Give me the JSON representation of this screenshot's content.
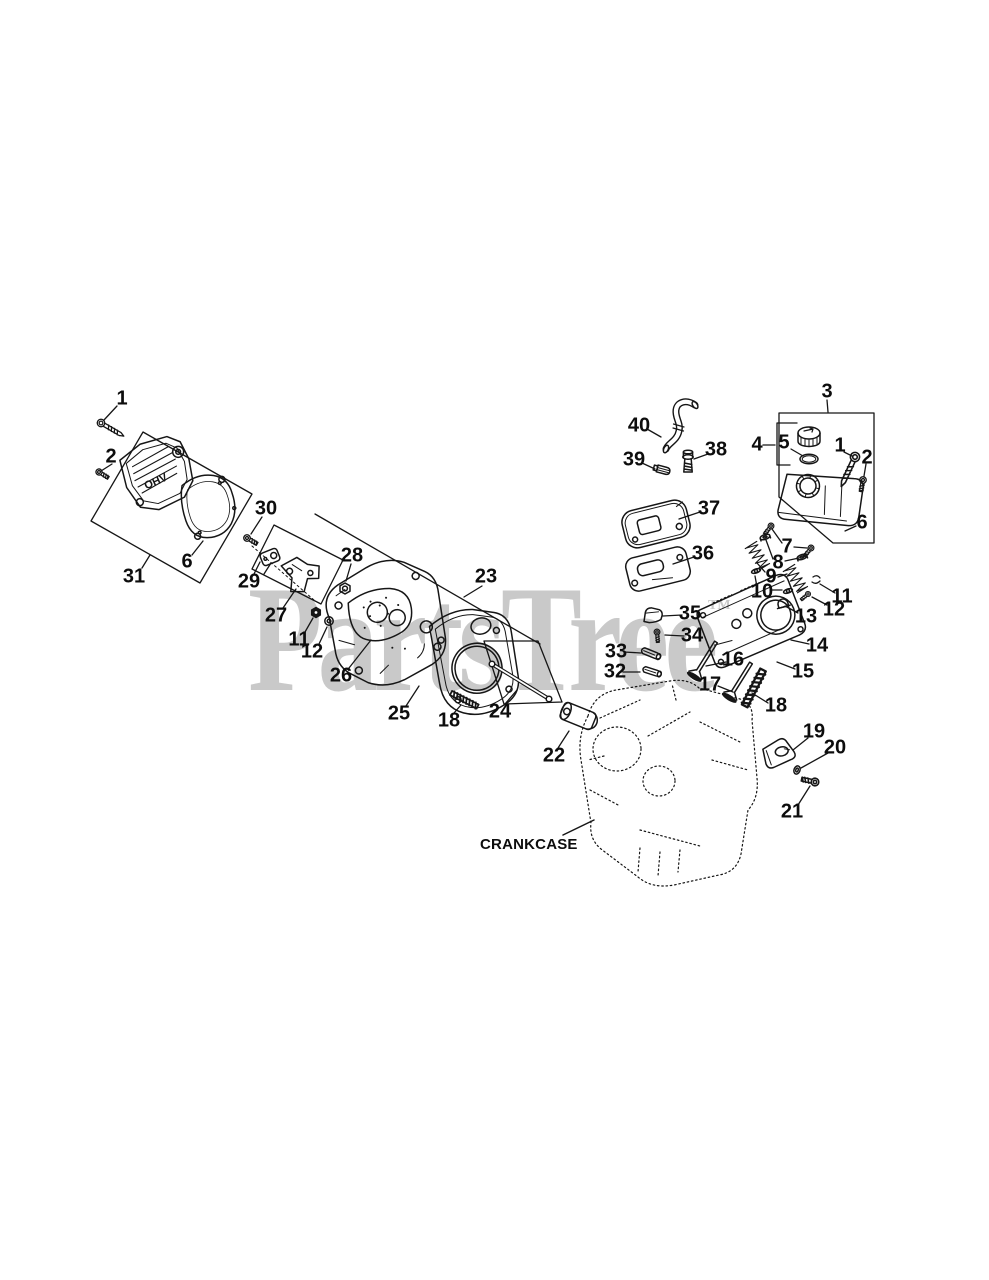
{
  "image": {
    "background": "#ffffff",
    "line_color": "#161616"
  },
  "watermark": {
    "text": "PartsTree",
    "tm": "TM",
    "color": "#c9c9c9"
  },
  "diagram": {
    "crankcase_label": "CRANKCASE",
    "cover_text": "OHV",
    "callouts": [
      {
        "n": "1",
        "x": 122,
        "y": 399,
        "L": [
          [
            117,
            406,
            104,
            420
          ]
        ]
      },
      {
        "n": "2",
        "x": 111,
        "y": 457,
        "L": [
          [
            112,
            464,
            101,
            471
          ]
        ]
      },
      {
        "n": "31",
        "x": 134,
        "y": 577,
        "L": [
          [
            142,
            568,
            150,
            555
          ]
        ]
      },
      {
        "n": "6",
        "x": 187,
        "y": 562,
        "L": [
          [
            192,
            555,
            203,
            541
          ]
        ]
      },
      {
        "n": "30",
        "x": 266,
        "y": 509,
        "L": [
          [
            262,
            517,
            251,
            534
          ]
        ]
      },
      {
        "n": "29",
        "x": 249,
        "y": 582,
        "L": [
          [
            254,
            574,
            260,
            562
          ],
          [
            264,
            574,
            271,
            563
          ]
        ]
      },
      {
        "n": "27",
        "x": 276,
        "y": 616,
        "L": [
          [
            283,
            608,
            296,
            589
          ]
        ]
      },
      {
        "n": "28",
        "x": 352,
        "y": 556,
        "L": [
          [
            351,
            564,
            346,
            581
          ]
        ]
      },
      {
        "n": "11",
        "x": 299,
        "y": 640,
        "L": [
          [
            305,
            632,
            313,
            618
          ]
        ]
      },
      {
        "n": "12",
        "x": 312,
        "y": 652,
        "L": [
          [
            319,
            644,
            327,
            627
          ]
        ]
      },
      {
        "n": "26",
        "x": 341,
        "y": 676,
        "L": [
          [
            349,
            668,
            371,
            640
          ]
        ]
      },
      {
        "n": "23",
        "x": 486,
        "y": 577,
        "L": [
          [
            482,
            586,
            464,
            597
          ]
        ]
      },
      {
        "n": "25",
        "x": 399,
        "y": 714,
        "L": [
          [
            406,
            706,
            419,
            686
          ]
        ]
      },
      {
        "n": "18",
        "x": 449,
        "y": 721,
        "L": [
          [
            454,
            713,
            461,
            705
          ]
        ]
      },
      {
        "n": "24",
        "x": 500,
        "y": 712,
        "L": [
          [
            505,
            704,
            517,
            690
          ]
        ]
      },
      {
        "n": "22",
        "x": 554,
        "y": 756,
        "L": [
          [
            558,
            748,
            569,
            731
          ]
        ]
      },
      {
        "n": "40",
        "x": 639,
        "y": 426,
        "L": [
          [
            647,
            429,
            661,
            437
          ]
        ]
      },
      {
        "n": "39",
        "x": 634,
        "y": 460,
        "L": [
          [
            642,
            463,
            655,
            469
          ]
        ]
      },
      {
        "n": "38",
        "x": 716,
        "y": 450,
        "L": [
          [
            708,
            454,
            694,
            459
          ]
        ]
      },
      {
        "n": "3",
        "x": 827,
        "y": 392,
        "L": [
          [
            827,
            400,
            828,
            412
          ]
        ]
      },
      {
        "n": "4",
        "x": 757,
        "y": 445,
        "L": [
          [
            763,
            445,
            775,
            445
          ]
        ]
      },
      {
        "n": "5",
        "x": 784,
        "y": 443,
        "L": [
          [
            791,
            449,
            803,
            456
          ]
        ]
      },
      {
        "n": "1",
        "x": 840,
        "y": 446,
        "L": [
          [
            844,
            452,
            852,
            456
          ]
        ]
      },
      {
        "n": "2",
        "x": 867,
        "y": 458,
        "L": [
          [
            866,
            464,
            864,
            476
          ]
        ]
      },
      {
        "n": "6",
        "x": 862,
        "y": 523,
        "L": [
          [
            856,
            526,
            845,
            531
          ]
        ]
      },
      {
        "n": "37",
        "x": 709,
        "y": 509,
        "L": [
          [
            700,
            512,
            679,
            519
          ]
        ]
      },
      {
        "n": "36",
        "x": 703,
        "y": 554,
        "L": [
          [
            694,
            557,
            673,
            564
          ]
        ]
      },
      {
        "n": "7",
        "x": 787,
        "y": 547,
        "L": [
          [
            782,
            543,
            772,
            529
          ],
          [
            794,
            547,
            807,
            548
          ]
        ]
      },
      {
        "n": "8",
        "x": 778,
        "y": 563,
        "L": [
          [
            773,
            559,
            766,
            540
          ],
          [
            785,
            561,
            799,
            558
          ]
        ]
      },
      {
        "n": "9",
        "x": 771,
        "y": 577,
        "L": [
          [
            765,
            572,
            757,
            563
          ],
          [
            778,
            577,
            787,
            574
          ]
        ]
      },
      {
        "n": "10",
        "x": 762,
        "y": 592,
        "L": [
          [
            770,
            590,
            782,
            590
          ],
          [
            757,
            587,
            755,
            576
          ]
        ]
      },
      {
        "n": "13",
        "x": 806,
        "y": 617,
        "L": [
          [
            798,
            613,
            785,
            606
          ]
        ]
      },
      {
        "n": "11",
        "x": 842,
        "y": 597,
        "L": [
          [
            835,
            593,
            820,
            584
          ]
        ]
      },
      {
        "n": "12",
        "x": 834,
        "y": 610,
        "L": [
          [
            827,
            605,
            812,
            597
          ]
        ]
      },
      {
        "n": "14",
        "x": 817,
        "y": 646,
        "L": [
          [
            809,
            644,
            791,
            640
          ]
        ]
      },
      {
        "n": "15",
        "x": 803,
        "y": 672,
        "L": [
          [
            795,
            669,
            777,
            662
          ]
        ]
      },
      {
        "n": "16",
        "x": 733,
        "y": 660,
        "L": [
          [
            726,
            662,
            706,
            666
          ]
        ]
      },
      {
        "n": "17",
        "x": 710,
        "y": 685,
        "L": [
          [
            718,
            686,
            733,
            692
          ]
        ]
      },
      {
        "n": "18",
        "x": 776,
        "y": 706,
        "L": [
          [
            768,
            703,
            752,
            693
          ]
        ]
      },
      {
        "n": "19",
        "x": 814,
        "y": 732,
        "L": [
          [
            808,
            738,
            793,
            750
          ]
        ]
      },
      {
        "n": "20",
        "x": 835,
        "y": 748,
        "L": [
          [
            828,
            753,
            801,
            768
          ]
        ]
      },
      {
        "n": "21",
        "x": 792,
        "y": 812,
        "L": [
          [
            798,
            805,
            810,
            786
          ]
        ]
      },
      {
        "n": "32",
        "x": 615,
        "y": 672,
        "L": [
          [
            623,
            672,
            640,
            672
          ]
        ]
      },
      {
        "n": "33",
        "x": 616,
        "y": 652,
        "L": [
          [
            624,
            652,
            641,
            653
          ]
        ]
      },
      {
        "n": "34",
        "x": 692,
        "y": 636,
        "L": [
          [
            684,
            636,
            665,
            635
          ]
        ]
      },
      {
        "n": "35",
        "x": 690,
        "y": 614,
        "L": [
          [
            682,
            615,
            663,
            616
          ]
        ]
      }
    ]
  }
}
